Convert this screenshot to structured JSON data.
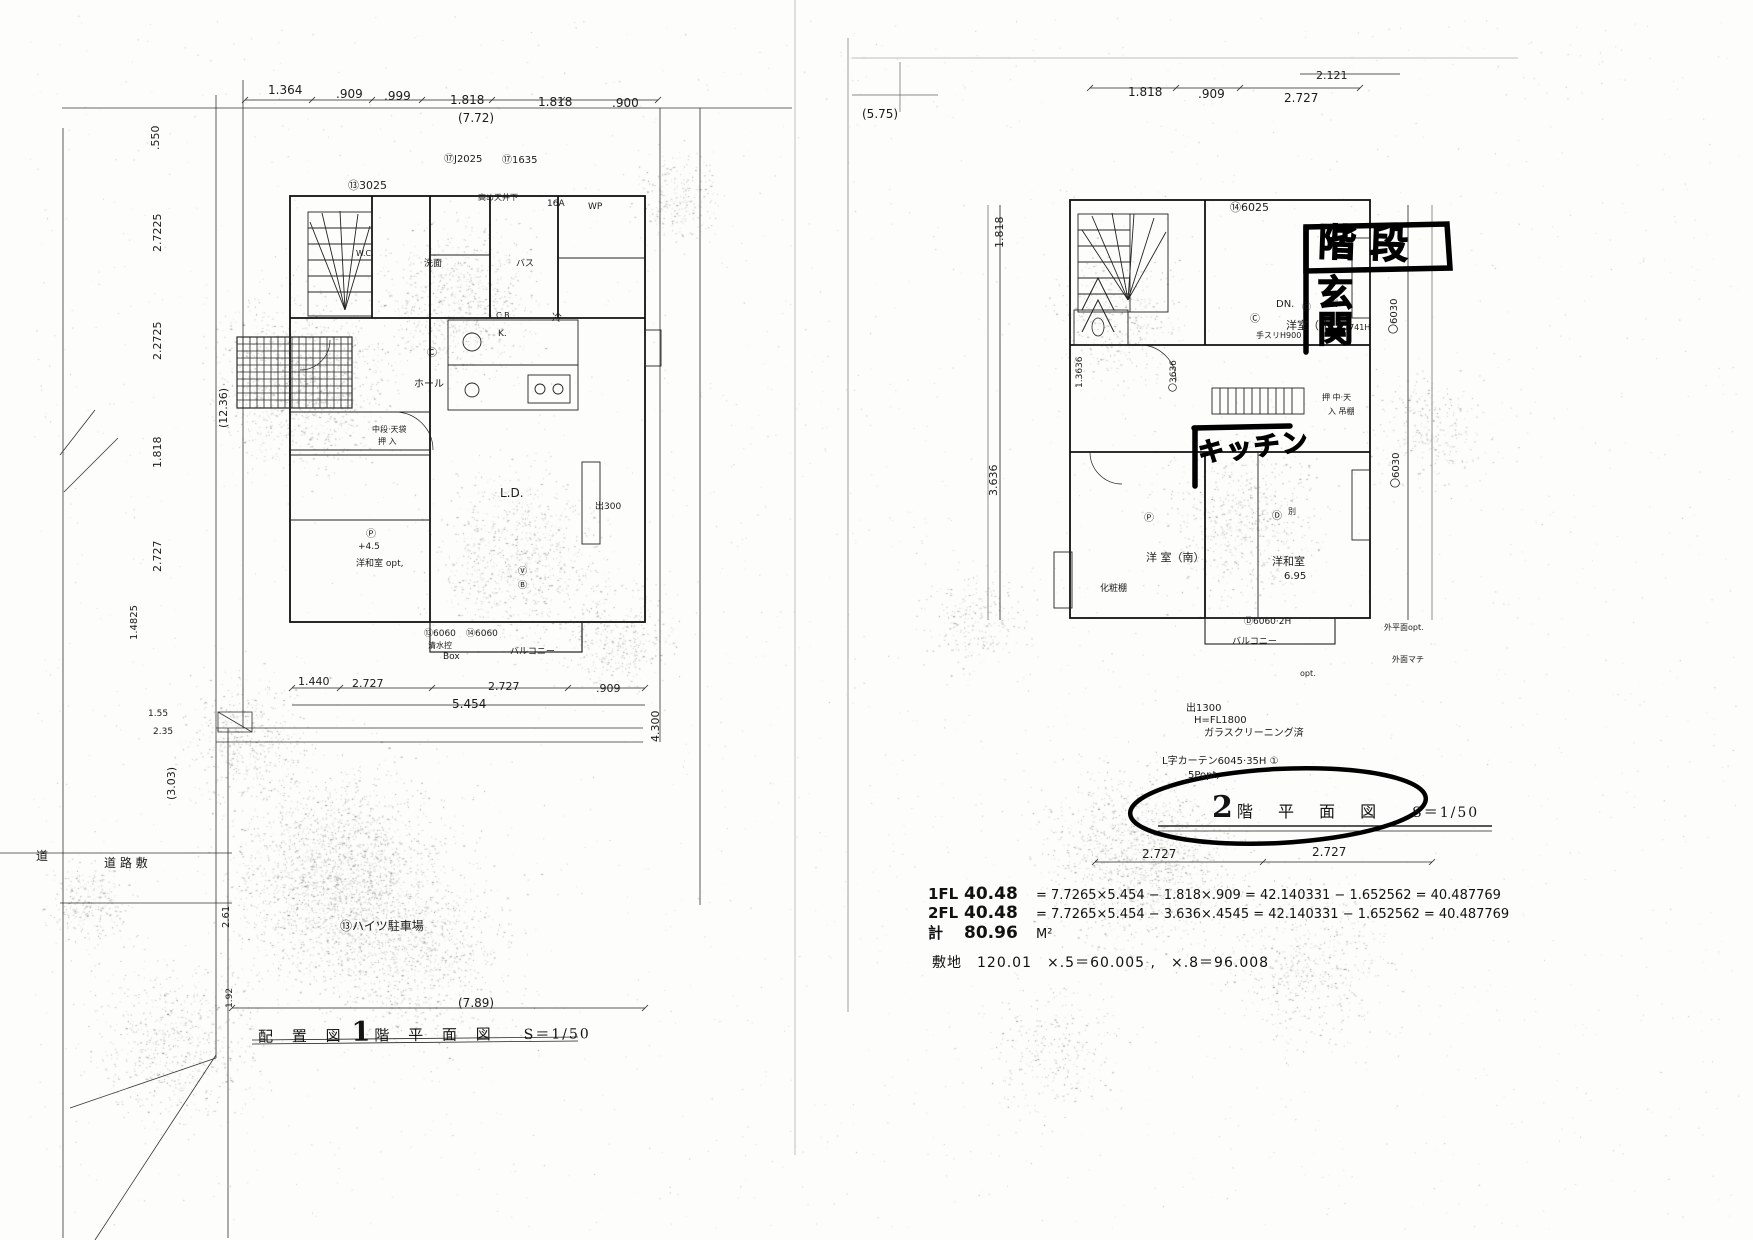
{
  "document": {
    "kind": "scanned architectural floor plan, 2 pages",
    "ink_color": "#1b1b1b",
    "marker_color": "#000000"
  },
  "left_page": {
    "title": {
      "prefix": "配 置 図",
      "floor_num": "1",
      "suffix": "階 平 面 図",
      "scale": "S＝1/50"
    },
    "labels": [
      {
        "t": "1.364",
        "x": 268,
        "y": 84,
        "s": 12
      },
      {
        "t": ".909",
        "x": 336,
        "y": 88,
        "s": 12
      },
      {
        "t": ".999",
        "x": 384,
        "y": 90,
        "s": 12
      },
      {
        "t": "1.818",
        "x": 450,
        "y": 94,
        "s": 12
      },
      {
        "t": "1.818",
        "x": 538,
        "y": 96,
        "s": 12
      },
      {
        "t": ".900",
        "x": 612,
        "y": 97,
        "s": 12
      },
      {
        "t": "(7.72)",
        "x": 458,
        "y": 112,
        "s": 12
      },
      {
        "t": "⑬3025",
        "x": 348,
        "y": 180,
        "s": 11
      },
      {
        "t": "⑰J2025",
        "x": 444,
        "y": 155,
        "s": 10
      },
      {
        "t": "⑰1635",
        "x": 502,
        "y": 156,
        "s": 10
      },
      {
        "t": "高め天井下",
        "x": 478,
        "y": 194,
        "s": 8
      },
      {
        "t": "16A",
        "x": 547,
        "y": 200,
        "s": 9
      },
      {
        "t": "WP",
        "x": 588,
        "y": 203,
        "s": 9
      },
      {
        "t": "W.C.",
        "x": 356,
        "y": 250,
        "s": 8
      },
      {
        "t": "洗面",
        "x": 424,
        "y": 260,
        "s": 9
      },
      {
        "t": "バス",
        "x": 516,
        "y": 260,
        "s": 9
      },
      {
        "t": "C.B.",
        "x": 496,
        "y": 312,
        "s": 8
      },
      {
        "t": "冷",
        "x": 552,
        "y": 314,
        "s": 10
      },
      {
        "t": "K.",
        "x": 498,
        "y": 330,
        "s": 9
      },
      {
        "t": "Ⓒ",
        "x": 427,
        "y": 349,
        "s": 10
      },
      {
        "t": "ホール",
        "x": 414,
        "y": 380,
        "s": 10
      },
      {
        "t": "中段·天袋",
        "x": 372,
        "y": 426,
        "s": 8
      },
      {
        "t": "押 入",
        "x": 378,
        "y": 438,
        "s": 8
      },
      {
        "t": "L.D.",
        "x": 500,
        "y": 487,
        "s": 12
      },
      {
        "t": "出300",
        "x": 595,
        "y": 503,
        "s": 9
      },
      {
        "t": "Ⓟ",
        "x": 366,
        "y": 530,
        "s": 10
      },
      {
        "t": "+4.5",
        "x": 358,
        "y": 543,
        "s": 9
      },
      {
        "t": "洋和室 opt,",
        "x": 356,
        "y": 560,
        "s": 9
      },
      {
        "t": "Ⓥ",
        "x": 518,
        "y": 568,
        "s": 9
      },
      {
        "t": "Ⓑ",
        "x": 518,
        "y": 582,
        "s": 9
      },
      {
        "t": "⑬6060",
        "x": 424,
        "y": 630,
        "s": 9
      },
      {
        "t": "清水控",
        "x": 428,
        "y": 642,
        "s": 8
      },
      {
        "t": "Box",
        "x": 443,
        "y": 653,
        "s": 9
      },
      {
        "t": "⑭6060",
        "x": 466,
        "y": 630,
        "s": 9
      },
      {
        "t": "バルコニー",
        "x": 510,
        "y": 648,
        "s": 9
      },
      {
        "t": "1.440",
        "x": 298,
        "y": 676,
        "s": 11
      },
      {
        "t": "2.727",
        "x": 352,
        "y": 678,
        "s": 11
      },
      {
        "t": "2.727",
        "x": 488,
        "y": 681,
        "s": 11
      },
      {
        "t": ".909",
        "x": 596,
        "y": 683,
        "s": 11
      },
      {
        "t": "5.454",
        "x": 452,
        "y": 698,
        "s": 12
      },
      {
        "t": "1.55",
        "x": 148,
        "y": 710,
        "s": 9
      },
      {
        "t": "2.35",
        "x": 153,
        "y": 728,
        "s": 9
      },
      {
        "t": "道",
        "x": 36,
        "y": 850,
        "s": 12
      },
      {
        "t": "道 路 敷",
        "x": 104,
        "y": 857,
        "s": 12
      },
      {
        "t": "⑬ハイツ駐車場",
        "x": 340,
        "y": 920,
        "s": 12
      },
      {
        "t": "(7.89)",
        "x": 458,
        "y": 997,
        "s": 12
      },
      {
        "t": ".550",
        "x": 150,
        "y": 150,
        "s": 11,
        "r": -90
      },
      {
        "t": "2.7225",
        "x": 152,
        "y": 252,
        "s": 11,
        "r": -90
      },
      {
        "t": "2.2725",
        "x": 152,
        "y": 360,
        "s": 11,
        "r": -90
      },
      {
        "t": "1.818",
        "x": 152,
        "y": 468,
        "s": 11,
        "r": -90
      },
      {
        "t": "2.727",
        "x": 152,
        "y": 572,
        "s": 11,
        "r": -90
      },
      {
        "t": "1.4825",
        "x": 130,
        "y": 640,
        "s": 10,
        "r": -90
      },
      {
        "t": "(12.36)",
        "x": 218,
        "y": 428,
        "s": 11,
        "r": -90
      },
      {
        "t": "(3.03)",
        "x": 166,
        "y": 800,
        "s": 11,
        "r": -90
      },
      {
        "t": "2.61",
        "x": 222,
        "y": 928,
        "s": 10,
        "r": -90
      },
      {
        "t": "1.92",
        "x": 226,
        "y": 1008,
        "s": 9,
        "r": -90
      },
      {
        "t": "4.300",
        "x": 650,
        "y": 742,
        "s": 11,
        "r": -90
      }
    ]
  },
  "right_page": {
    "title": {
      "floor_num": "2",
      "suffix": "階 平 面 図",
      "scale": "S＝1/50"
    },
    "marker": {
      "stairs": "階段",
      "entrance": "玄関",
      "kitchen": "キッチン"
    },
    "labels": [
      {
        "t": "(5.75)",
        "x": 862,
        "y": 108,
        "s": 12
      },
      {
        "t": "1.818",
        "x": 1128,
        "y": 86,
        "s": 12
      },
      {
        "t": ".909",
        "x": 1198,
        "y": 88,
        "s": 12
      },
      {
        "t": "2.727",
        "x": 1284,
        "y": 92,
        "s": 12
      },
      {
        "t": "2.121",
        "x": 1316,
        "y": 70,
        "s": 11
      },
      {
        "t": "⑭6025",
        "x": 1230,
        "y": 202,
        "s": 11
      },
      {
        "t": "DN.",
        "x": 1276,
        "y": 300,
        "s": 10
      },
      {
        "t": "Ⓒ",
        "x": 1250,
        "y": 315,
        "s": 10
      },
      {
        "t": "手スリH900",
        "x": 1256,
        "y": 332,
        "s": 8
      },
      {
        "t": "2741H",
        "x": 1344,
        "y": 324,
        "s": 8
      },
      {
        "t": "Ⓒ",
        "x": 1302,
        "y": 304,
        "s": 9
      },
      {
        "t": "別",
        "x": 1330,
        "y": 300,
        "s": 8
      },
      {
        "t": "洋室（北）",
        "x": 1286,
        "y": 320,
        "s": 11
      },
      {
        "t": "押 中·天",
        "x": 1322,
        "y": 394,
        "s": 8
      },
      {
        "t": "入 吊棚",
        "x": 1328,
        "y": 408,
        "s": 8
      },
      {
        "t": "Ⓟ",
        "x": 1144,
        "y": 514,
        "s": 10
      },
      {
        "t": "洋 室（南）",
        "x": 1146,
        "y": 552,
        "s": 11
      },
      {
        "t": "化粧棚",
        "x": 1100,
        "y": 585,
        "s": 9
      },
      {
        "t": "Ⓓ",
        "x": 1272,
        "y": 512,
        "s": 10
      },
      {
        "t": "別",
        "x": 1288,
        "y": 508,
        "s": 8
      },
      {
        "t": "洋和室",
        "x": 1272,
        "y": 556,
        "s": 11
      },
      {
        "t": "6.95",
        "x": 1284,
        "y": 572,
        "s": 10
      },
      {
        "t": "Ⓓ6060·2H",
        "x": 1244,
        "y": 618,
        "s": 9
      },
      {
        "t": "バルコニー",
        "x": 1232,
        "y": 638,
        "s": 9
      },
      {
        "t": "外平面opt.",
        "x": 1384,
        "y": 624,
        "s": 8
      },
      {
        "t": "外面マチ",
        "x": 1392,
        "y": 656,
        "s": 8
      },
      {
        "t": "opt.",
        "x": 1300,
        "y": 670,
        "s": 8
      },
      {
        "t": "出1300",
        "x": 1186,
        "y": 704,
        "s": 10
      },
      {
        "t": "H=FL1800",
        "x": 1194,
        "y": 716,
        "s": 10
      },
      {
        "t": "ガラスクリーニング済",
        "x": 1204,
        "y": 729,
        "s": 10
      },
      {
        "t": "L字カーテン6045·35H ①",
        "x": 1162,
        "y": 757,
        "s": 10
      },
      {
        "t": "5Popt,",
        "x": 1188,
        "y": 771,
        "s": 10
      },
      {
        "t": "2.727",
        "x": 1142,
        "y": 848,
        "s": 12
      },
      {
        "t": "2.727",
        "x": 1312,
        "y": 846,
        "s": 12
      },
      {
        "t": "1.818",
        "x": 994,
        "y": 248,
        "s": 11,
        "r": -90
      },
      {
        "t": "1.3636",
        "x": 1076,
        "y": 388,
        "s": 9,
        "r": -90
      },
      {
        "t": "〇3636",
        "x": 1170,
        "y": 392,
        "s": 9,
        "r": -90
      },
      {
        "t": "3.636",
        "x": 988,
        "y": 496,
        "s": 11,
        "r": -90
      },
      {
        "t": "〇6030",
        "x": 1390,
        "y": 334,
        "s": 10,
        "r": -90
      },
      {
        "t": "〇6030",
        "x": 1392,
        "y": 488,
        "s": 10,
        "r": -90
      }
    ]
  },
  "calculations": {
    "rows": [
      {
        "label": "1FL",
        "area": "40.48",
        "expr": "= 7.7265×5.454 − 1.818×.909 = 42.140331 − 1.652562 = 40.487769"
      },
      {
        "label": "2FL",
        "area": "40.48",
        "expr": "= 7.7265×5.454 − 3.636×.4545 = 42.140331 − 1.652562 = 40.487769"
      },
      {
        "label": "計",
        "area": "80.96",
        "expr": "M²"
      }
    ],
    "site_line": "敷地　120.01　×.5＝60.005 ,　×.8＝96.008"
  }
}
